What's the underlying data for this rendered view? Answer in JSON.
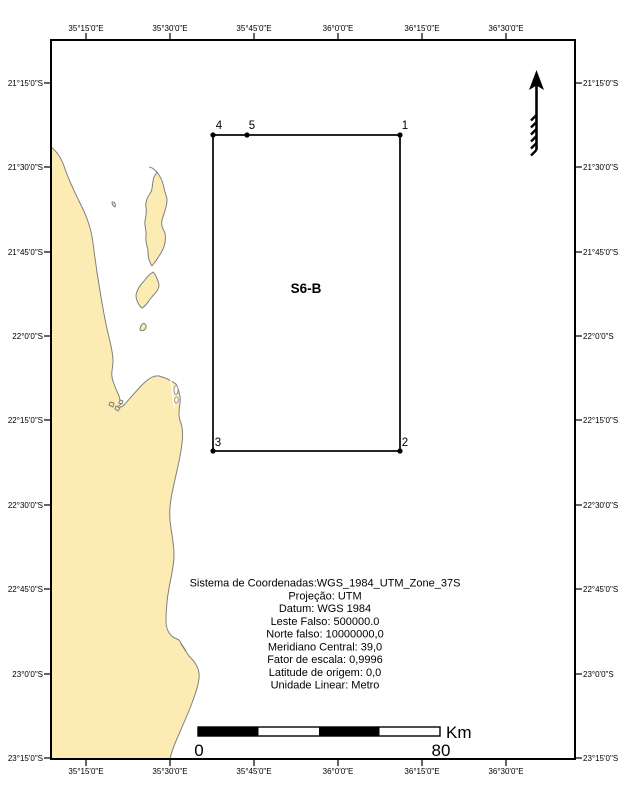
{
  "map": {
    "area_label": "S6-B",
    "points": [
      {
        "id": "1"
      },
      {
        "id": "2"
      },
      {
        "id": "3"
      },
      {
        "id": "4"
      },
      {
        "id": "5"
      }
    ]
  },
  "axes": {
    "lon_labels": [
      "35°15'0\"E",
      "35°30'0\"E",
      "35°45'0\"E",
      "36°0'0\"E",
      "36°15'0\"E",
      "36°30'0\"E"
    ],
    "lat_labels": [
      "21°15'0\"S",
      "21°30'0\"S",
      "21°45'0\"S",
      "22°0'0\"S",
      "22°15'0\"S",
      "22°30'0\"S",
      "22°45'0\"S",
      "23°0'0\"S",
      "23°15'0\"S"
    ]
  },
  "projection_info": {
    "lines": [
      "Sistema de Coordenadas:WGS_1984_UTM_Zone_37S",
      "Projeção: UTM",
      "Datum: WGS 1984",
      "Leste Falso: 500000.0",
      "Norte falso: 10000000,0",
      "Meridiano Central: 39,0",
      "Fator de escala: 0,9996",
      "Latitude de origem: 0,0",
      "Unidade Linear: Metro"
    ]
  },
  "scale_bar": {
    "start_label": "0",
    "end_label": "80",
    "unit": "Km"
  },
  "colors": {
    "land": "#FDEBB4",
    "land_outline": "#7F7F7F",
    "frame": "#000000",
    "ocean": "#FFFFFF"
  }
}
